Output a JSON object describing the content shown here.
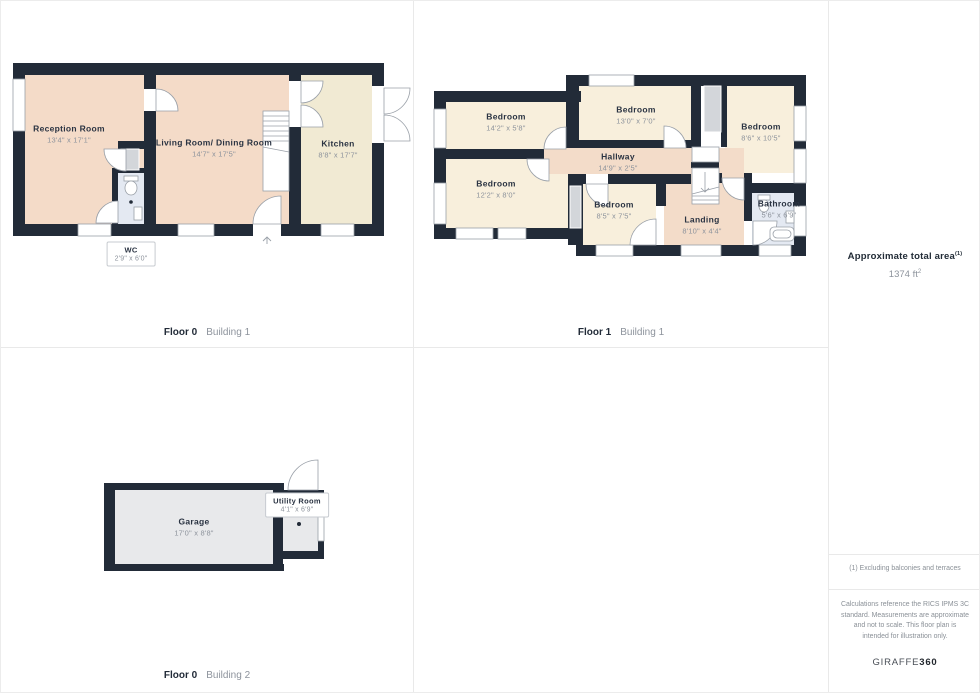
{
  "colors": {
    "wall": "#222b38",
    "room_warm": "#f4dbc8",
    "room_cream": "#f1ead3",
    "room_pale_cream": "#f8efdc",
    "room_wet_blue": "#e4e9f2",
    "room_gray": "#e8e9eb",
    "cupboard_gray": "#d3d6da",
    "line_gray": "#9aa0a8",
    "text_dark": "#2a3342",
    "text_muted": "#8d939c"
  },
  "floor0_building1": {
    "floor_label": "Floor 0",
    "building_label": "Building 1",
    "reception": {
      "name": "Reception Room",
      "dims": "13'4\" x 17'1\""
    },
    "living": {
      "name": "Living Room/ Dining Room",
      "dims": "14'7\" x 17'5\""
    },
    "kitchen": {
      "name": "Kitchen",
      "dims": "8'8\" x 17'7\""
    },
    "wc": {
      "name": "WC",
      "dims": "2'9\" x 6'0\""
    }
  },
  "floor1_building1": {
    "floor_label": "Floor 1",
    "building_label": "Building 1",
    "bedroom_top_left": {
      "name": "Bedroom",
      "dims": "14'2\" x 5'8\""
    },
    "bedroom_top_middle": {
      "name": "Bedroom",
      "dims": "13'0\" x 7'0\""
    },
    "bedroom_right": {
      "name": "Bedroom",
      "dims": "8'6\" x 10'5\""
    },
    "hallway": {
      "name": "Hallway",
      "dims": "14'9\" x 2'5\""
    },
    "bedroom_left": {
      "name": "Bedroom",
      "dims": "12'2\" x 8'0\""
    },
    "bedroom_middle": {
      "name": "Bedroom",
      "dims": "8'5\" x 7'5\""
    },
    "landing": {
      "name": "Landing",
      "dims": "8'10\" x 4'4\""
    },
    "bathroom": {
      "name": "Bathroom",
      "dims": "5'6\" x 6'9\""
    }
  },
  "floor0_building2": {
    "floor_label": "Floor 0",
    "building_label": "Building 2",
    "garage": {
      "name": "Garage",
      "dims": "17'0\" x 8'8\""
    },
    "utility": {
      "name": "Utility Room",
      "dims": "4'1\" x 6'9\""
    }
  },
  "sidebar": {
    "total_area_label": "Approximate total area",
    "total_area_footnote_marker": "(1)",
    "total_area_value": "1374 ft",
    "total_area_value_exponent": "2",
    "footnote": "(1) Excluding balconies and terraces",
    "disclaimer": "Calculations reference the RICS IPMS 3C standard. Measurements are approximate and not to scale. This floor plan is intended for illustration only.",
    "brand_name": "GIRAFFE",
    "brand_number": "360"
  }
}
